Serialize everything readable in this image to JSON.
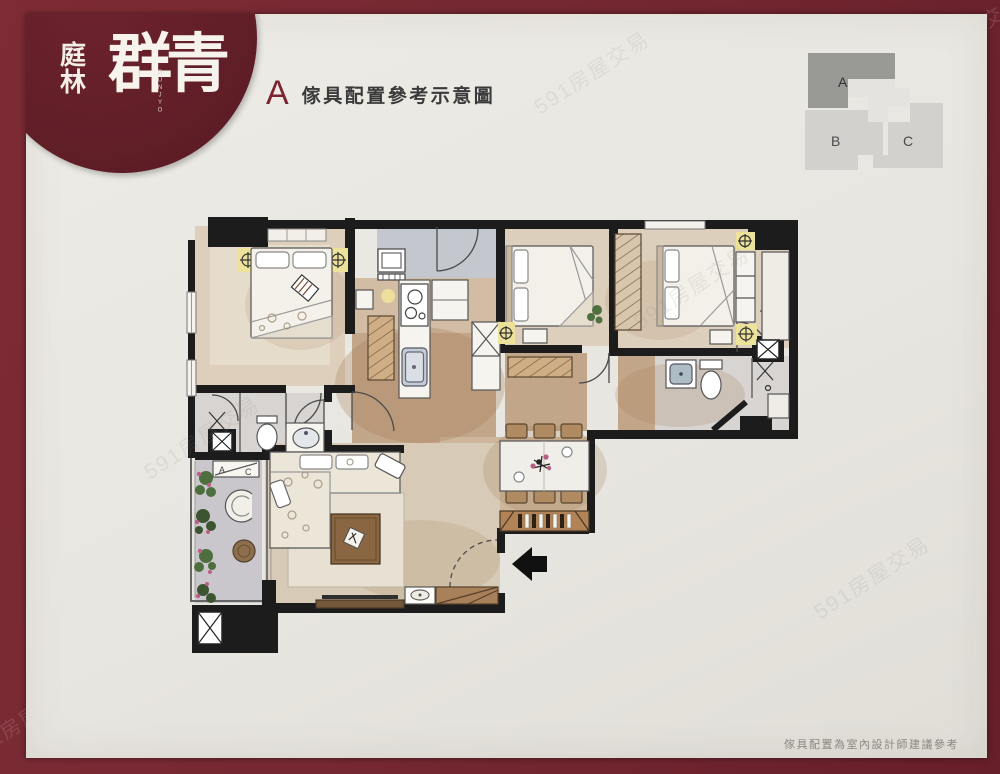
{
  "page": {
    "frame_color": "#752832",
    "paper_color": "#e9e7e1",
    "footer_note": "傢具配置為室內設計師建議參考",
    "watermark": "591房屋交易"
  },
  "logo": {
    "brand_color": "#63202a",
    "char_top": "庭",
    "char_bottom": "林",
    "brand": "群青",
    "romanization": "GUNJYO"
  },
  "header": {
    "unit_letter": "A",
    "title": "傢具配置參考示意圖"
  },
  "keyplan": {
    "unit_a": "A",
    "unit_b": "B",
    "unit_c": "C",
    "highlighted_unit": "A"
  },
  "floorplan": {
    "ac_label_left": "A",
    "ac_label_right": "C"
  }
}
